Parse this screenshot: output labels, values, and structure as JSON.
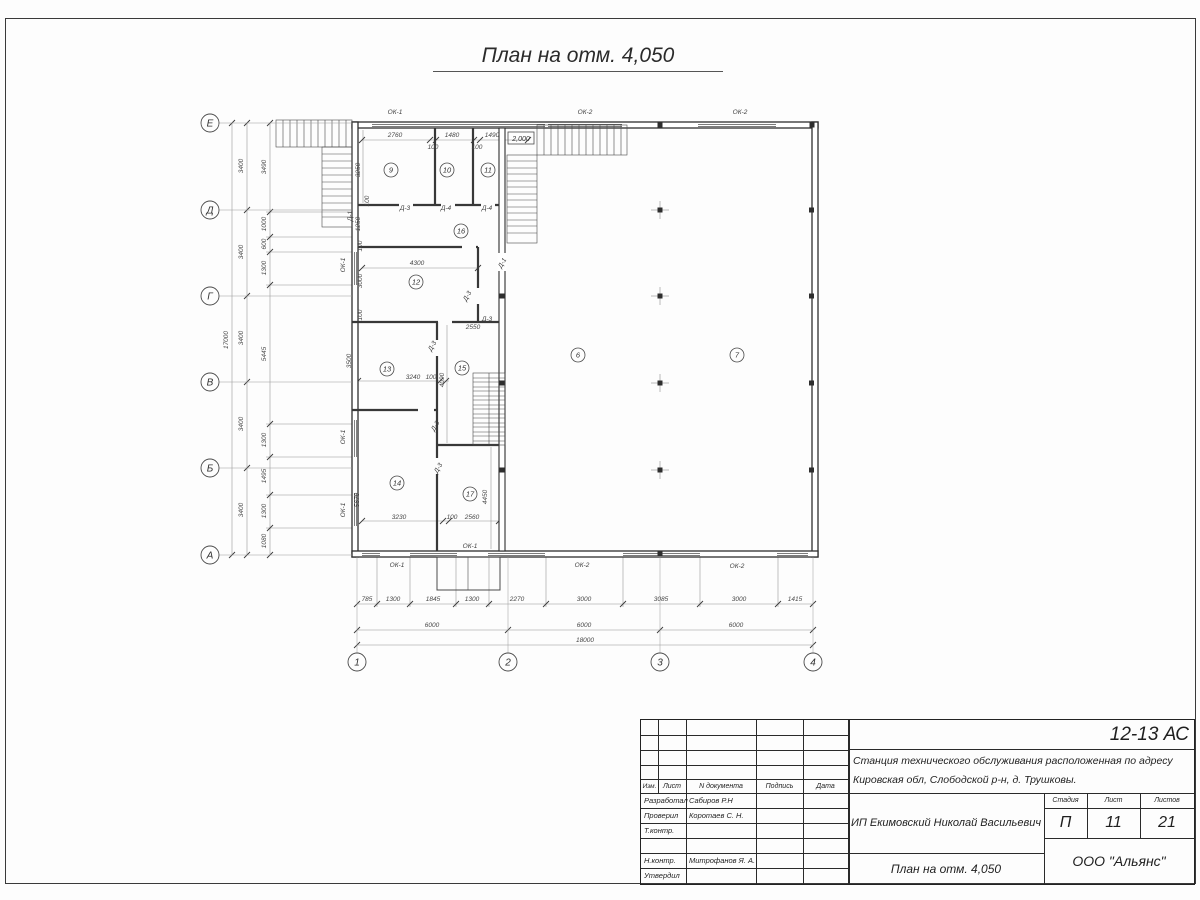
{
  "sheet": {
    "page_title": "План на отм. 4,050"
  },
  "titleblock": {
    "code": "12-13 АС",
    "doc_line1": "Станция технического обслуживания расположенная по адресу",
    "doc_line2": "Кировская обл, Слободской р-н, д. Трушковы.",
    "cols": {
      "izm": "Изм.",
      "list": "Лист",
      "ndoc": "N документа",
      "sign": "Подпись",
      "date": "Дата"
    },
    "rows": [
      {
        "role": "Разработал",
        "name": "Сабиров Р.Н"
      },
      {
        "role": "Проверил",
        "name": "Коротаев С. Н."
      },
      {
        "role": "Т.контр.",
        "name": ""
      },
      {
        "role": "",
        "name": ""
      },
      {
        "role": "Н.контр.",
        "name": "Митрофанов Я. А."
      },
      {
        "role": "Утвердил",
        "name": ""
      }
    ],
    "client": "ИП Екимовский Николай Васильевич",
    "stage_label": "Стадия",
    "sheet_label": "Лист",
    "sheets_label": "Листов",
    "stage": "П",
    "sheet_no": "11",
    "sheets_total": "21",
    "drawing_name": "План на отм. 4,050",
    "company": "ООО \"Альянс\""
  },
  "plan": {
    "line_color": "#2e2e2e",
    "elevation_mark": "2,000",
    "axes_v": [
      {
        "t": "Е",
        "x": 210,
        "y": 123
      },
      {
        "t": "Д",
        "x": 210,
        "y": 210
      },
      {
        "t": "Г",
        "x": 210,
        "y": 296
      },
      {
        "t": "В",
        "x": 210,
        "y": 382
      },
      {
        "t": "Б",
        "x": 210,
        "y": 468
      },
      {
        "t": "А",
        "x": 210,
        "y": 555
      }
    ],
    "axes_h": [
      {
        "t": "1",
        "x": 357,
        "y": 662
      },
      {
        "t": "2",
        "x": 508,
        "y": 662
      },
      {
        "t": "3",
        "x": 660,
        "y": 662
      },
      {
        "t": "4",
        "x": 813,
        "y": 662
      }
    ],
    "rooms": [
      {
        "t": "9",
        "x": 391,
        "y": 170
      },
      {
        "t": "10",
        "x": 447,
        "y": 170
      },
      {
        "t": "11",
        "x": 488,
        "y": 170
      },
      {
        "t": "16",
        "x": 461,
        "y": 231
      },
      {
        "t": "12",
        "x": 416,
        "y": 282
      },
      {
        "t": "13",
        "x": 387,
        "y": 369
      },
      {
        "t": "15",
        "x": 462,
        "y": 368
      },
      {
        "t": "14",
        "x": 397,
        "y": 483
      },
      {
        "t": "17",
        "x": 470,
        "y": 494
      },
      {
        "t": "6",
        "x": 578,
        "y": 355
      },
      {
        "t": "7",
        "x": 737,
        "y": 355
      }
    ],
    "texts": [
      {
        "t": "785",
        "x": 367,
        "y": 601
      },
      {
        "t": "1300",
        "x": 393,
        "y": 601
      },
      {
        "t": "1845",
        "x": 433,
        "y": 601
      },
      {
        "t": "1300",
        "x": 472,
        "y": 601
      },
      {
        "t": "2270",
        "x": 517,
        "y": 601
      },
      {
        "t": "3000",
        "x": 584,
        "y": 601
      },
      {
        "t": "3085",
        "x": 661,
        "y": 601
      },
      {
        "t": "3000",
        "x": 739,
        "y": 601
      },
      {
        "t": "1415",
        "x": 795,
        "y": 601
      },
      {
        "t": "6000",
        "x": 432,
        "y": 627
      },
      {
        "t": "6000",
        "x": 584,
        "y": 627
      },
      {
        "t": "6000",
        "x": 736,
        "y": 627
      },
      {
        "t": "18000",
        "x": 585,
        "y": 642
      },
      {
        "t": "17000",
        "x": 228,
        "y": 340,
        "r": -90
      },
      {
        "t": "3400",
        "x": 243,
        "y": 166,
        "r": -90
      },
      {
        "t": "3400",
        "x": 243,
        "y": 252,
        "r": -90
      },
      {
        "t": "3400",
        "x": 243,
        "y": 338,
        "r": -90
      },
      {
        "t": "3400",
        "x": 243,
        "y": 424,
        "r": -90
      },
      {
        "t": "3400",
        "x": 243,
        "y": 510,
        "r": -90
      },
      {
        "t": "3490",
        "x": 266,
        "y": 167,
        "r": -90
      },
      {
        "t": "1000",
        "x": 266,
        "y": 224,
        "r": -90
      },
      {
        "t": "600",
        "x": 266,
        "y": 244,
        "r": -90
      },
      {
        "t": "1300",
        "x": 266,
        "y": 268,
        "r": -90
      },
      {
        "t": "5445",
        "x": 266,
        "y": 354,
        "r": -90
      },
      {
        "t": "1300",
        "x": 266,
        "y": 440,
        "r": -90
      },
      {
        "t": "1495",
        "x": 266,
        "y": 476,
        "r": -90
      },
      {
        "t": "1300",
        "x": 266,
        "y": 511,
        "r": -90
      },
      {
        "t": "1080",
        "x": 266,
        "y": 541,
        "r": -90
      },
      {
        "t": "2760",
        "x": 395,
        "y": 137
      },
      {
        "t": "1480",
        "x": 452,
        "y": 137
      },
      {
        "t": "1490",
        "x": 492,
        "y": 137
      },
      {
        "t": "100",
        "x": 433,
        "y": 149
      },
      {
        "t": "100",
        "x": 477,
        "y": 149
      },
      {
        "t": "3250",
        "x": 360,
        "y": 170,
        "r": -90
      },
      {
        "t": "Д-1",
        "x": 352,
        "y": 216,
        "r": -90,
        "c": "lbl"
      },
      {
        "t": "1250",
        "x": 360,
        "y": 224,
        "r": -90
      },
      {
        "t": "100",
        "x": 369,
        "y": 201,
        "r": -90
      },
      {
        "t": "4300",
        "x": 417,
        "y": 265
      },
      {
        "t": "3000",
        "x": 362,
        "y": 281,
        "r": -90
      },
      {
        "t": "100",
        "x": 362,
        "y": 246,
        "r": -90
      },
      {
        "t": "100",
        "x": 362,
        "y": 315,
        "r": -90
      },
      {
        "t": "2550",
        "x": 473,
        "y": 329
      },
      {
        "t": "Д-3",
        "x": 487,
        "y": 321,
        "c": "lbl"
      },
      {
        "t": "Д-3",
        "x": 469,
        "y": 297,
        "r": -60,
        "c": "lbl"
      },
      {
        "t": "3240",
        "x": 413,
        "y": 379
      },
      {
        "t": "100",
        "x": 431,
        "y": 379
      },
      {
        "t": "4090",
        "x": 444,
        "y": 380,
        "r": -90
      },
      {
        "t": "3500",
        "x": 351,
        "y": 361,
        "r": -90
      },
      {
        "t": "Д-3",
        "x": 434,
        "y": 347,
        "r": -60,
        "c": "lbl"
      },
      {
        "t": "3230",
        "x": 399,
        "y": 519
      },
      {
        "t": "100",
        "x": 452,
        "y": 519
      },
      {
        "t": "2560",
        "x": 472,
        "y": 519
      },
      {
        "t": "5670",
        "x": 359,
        "y": 500,
        "r": -90
      },
      {
        "t": "4450",
        "x": 487,
        "y": 497,
        "r": -90
      },
      {
        "t": "Д-3",
        "x": 437,
        "y": 427,
        "r": -60,
        "c": "lbl"
      },
      {
        "t": "Д-3",
        "x": 440,
        "y": 469,
        "r": -60,
        "c": "lbl"
      },
      {
        "t": "Д-1",
        "x": 504,
        "y": 264,
        "r": -60,
        "c": "lbl"
      },
      {
        "t": "Д-3",
        "x": 405,
        "y": 210,
        "c": "lbl"
      },
      {
        "t": "Д-4",
        "x": 446,
        "y": 210,
        "c": "lbl"
      },
      {
        "t": "Д-4",
        "x": 487,
        "y": 210,
        "c": "lbl"
      },
      {
        "t": "ОК-1",
        "x": 395,
        "y": 114,
        "c": "lbl"
      },
      {
        "t": "ОК-2",
        "x": 585,
        "y": 114,
        "c": "lbl"
      },
      {
        "t": "ОК-2",
        "x": 740,
        "y": 114,
        "c": "lbl"
      },
      {
        "t": "ОК-1",
        "x": 397,
        "y": 567,
        "c": "lbl"
      },
      {
        "t": "ОК-1",
        "x": 470,
        "y": 548,
        "c": "lbl"
      },
      {
        "t": "ОК-2",
        "x": 582,
        "y": 567,
        "c": "lbl"
      },
      {
        "t": "ОК-2",
        "x": 737,
        "y": 568,
        "c": "lbl"
      },
      {
        "t": "ОК-1",
        "x": 345,
        "y": 265,
        "r": -90,
        "c": "lbl"
      },
      {
        "t": "ОК-1",
        "x": 345,
        "y": 437,
        "r": -90,
        "c": "lbl"
      },
      {
        "t": "ОК-1",
        "x": 345,
        "y": 510,
        "r": -90,
        "c": "lbl"
      },
      {
        "t": "2,000",
        "x": 521,
        "y": 141,
        "c": "elev",
        "n": "elevation-mark"
      }
    ]
  }
}
